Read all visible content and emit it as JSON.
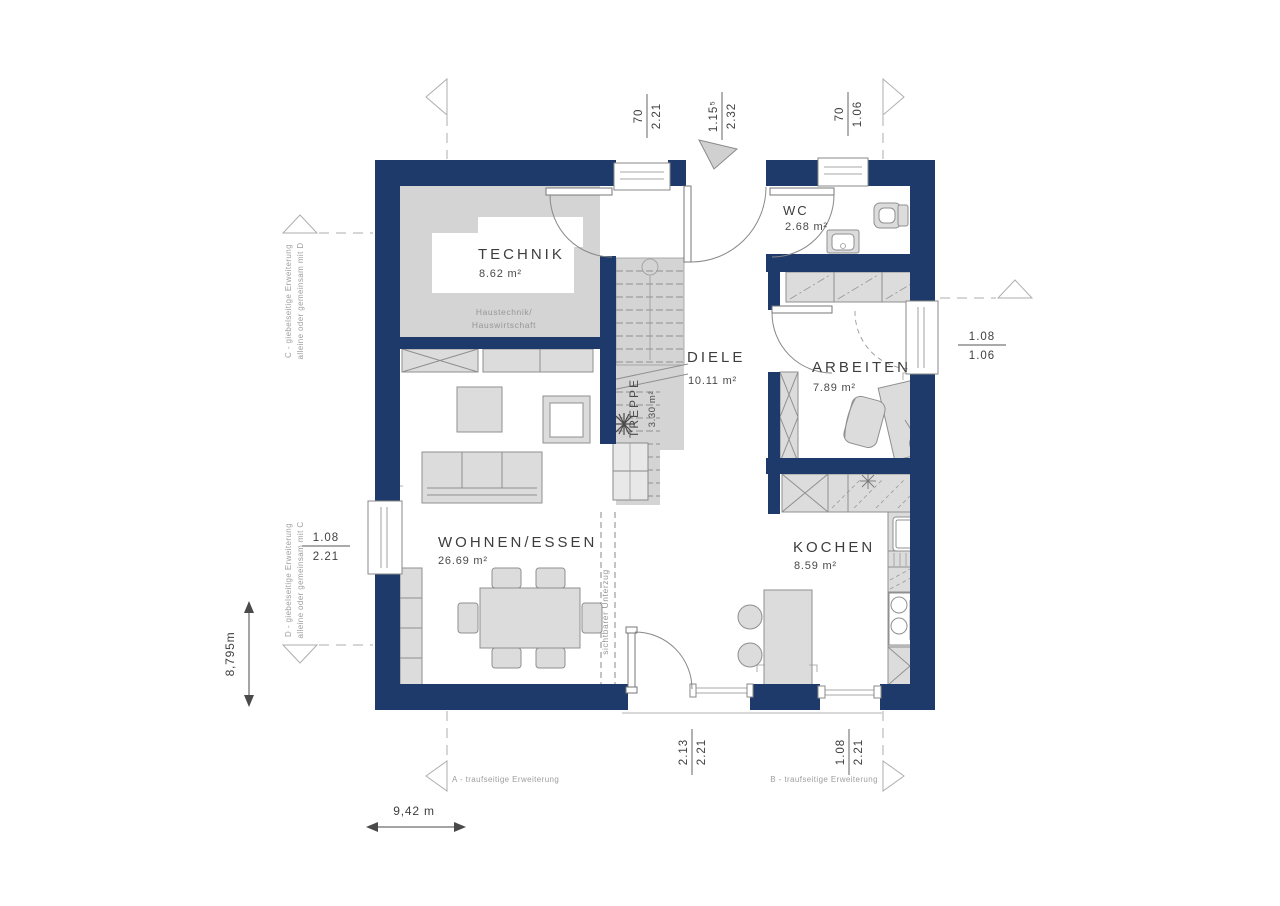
{
  "plan": {
    "rooms": {
      "technik": {
        "name": "TECHNIK",
        "area": "8.62 m²",
        "note_line1": "Haustechnik/",
        "note_line2": "Hauswirtschaft"
      },
      "wc": {
        "name": "WC",
        "area": "2.68 m²"
      },
      "diele": {
        "name": "DIELE",
        "area": "10.11 m²"
      },
      "treppe": {
        "name": "TREPPE",
        "area": "3.30 m²"
      },
      "arbeiten": {
        "name": "ARBEITEN",
        "area": "7.89 m²"
      },
      "wohnen_essen": {
        "name": "WOHNEN/ESSEN",
        "area": "26.69 m²"
      },
      "kochen": {
        "name": "KOCHEN",
        "area": "8.59 m²"
      }
    },
    "annotations": {
      "beam": "sichtbarer Unterzug",
      "ext_a": "A - traufseitige Erweiterung",
      "ext_b": "B - traufseitige Erweiterung",
      "ext_c_line1": "C - giebelseitige Erweiterung",
      "ext_c_line2": "alleine oder gemeinsam mit D",
      "ext_d_line1": "D - giebelseitige Erweiterung",
      "ext_d_line2": "alleine oder gemeinsam mit C"
    },
    "dimensions": {
      "overall_width": "9,42 m",
      "overall_height": "8,795m",
      "top_window": {
        "num": "70",
        "den": "2.21"
      },
      "entrance_door": {
        "num": "1.15⁵",
        "den": "2.32"
      },
      "wc_window": {
        "num": "70",
        "den": "1.06"
      },
      "arbeiten_window": {
        "num": "1.08",
        "den": "1.06"
      },
      "wohnen_window": {
        "num": "1.08",
        "den": "2.21"
      },
      "terrace_door": {
        "num": "2.13",
        "den": "2.21"
      },
      "kochen_window": {
        "num": "1.08",
        "den": "2.21"
      }
    },
    "colors": {
      "wall": "#1e3a6a",
      "shaded_floor": "#d4d4d4",
      "furniture": "#dcdcdc"
    }
  }
}
